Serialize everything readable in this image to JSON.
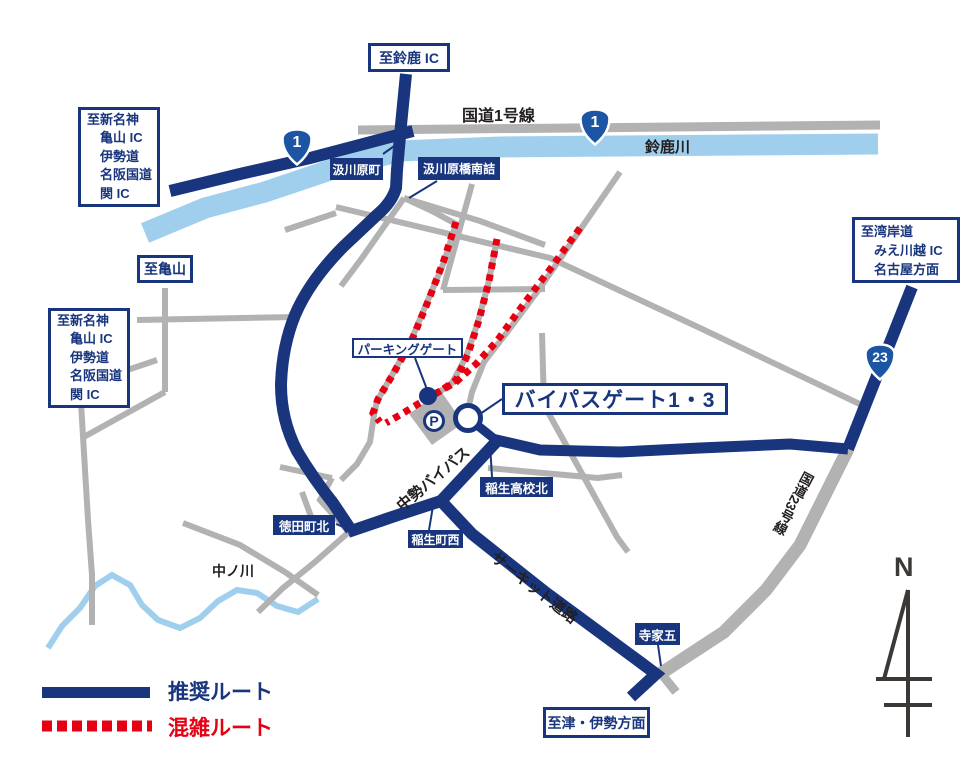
{
  "title": "鈴鹿サーキット周辺アクセスマップ",
  "destinations": {
    "suzuka_ic": "至鈴鹿 IC",
    "shin_meishin": [
      "至新名神",
      "亀山 IC",
      "伊勢道",
      "名阪国道",
      "関 IC"
    ],
    "kameyama": "至亀山",
    "wangan": [
      "至湾岸道",
      "みえ川越 IC",
      "名古屋方面"
    ],
    "tsu_ise": "至津・伊勢方面"
  },
  "junctions": {
    "kumikawahara": "汲川原町",
    "kumikawahara_bashi_minami": "汲川原橋南詰",
    "tokudacho_kita": "徳田町北",
    "inocho_nishi": "稲生町西",
    "ino_koko_kita": "稲生高校北",
    "jike_go": "寺家五"
  },
  "gates": {
    "parking_gate": "パーキングゲート",
    "bypass_gate": "バイパスゲート1・3"
  },
  "roads": {
    "route1_label": "国道1号線",
    "suzuka_river": "鈴鹿川",
    "nakano_river": "中ノ川",
    "chusei_bypass": "中勢バイパス",
    "circuit_road": "サーキット道路",
    "route23_label": "国道23号線"
  },
  "shields": [
    {
      "route": "1"
    },
    {
      "route": "1"
    },
    {
      "route": "23"
    }
  ],
  "legend": {
    "recommended": "推奨ルート",
    "congested": "混雑ルート"
  },
  "parking": {
    "symbol": "P"
  },
  "compass": {
    "north": "N"
  },
  "colors": {
    "navy_route": "#18357d",
    "congestion_red": "#e60012",
    "gray_road": "#b2b2b2",
    "river_blue": "#a0cfee",
    "shield_blue": "#1c55a4"
  }
}
